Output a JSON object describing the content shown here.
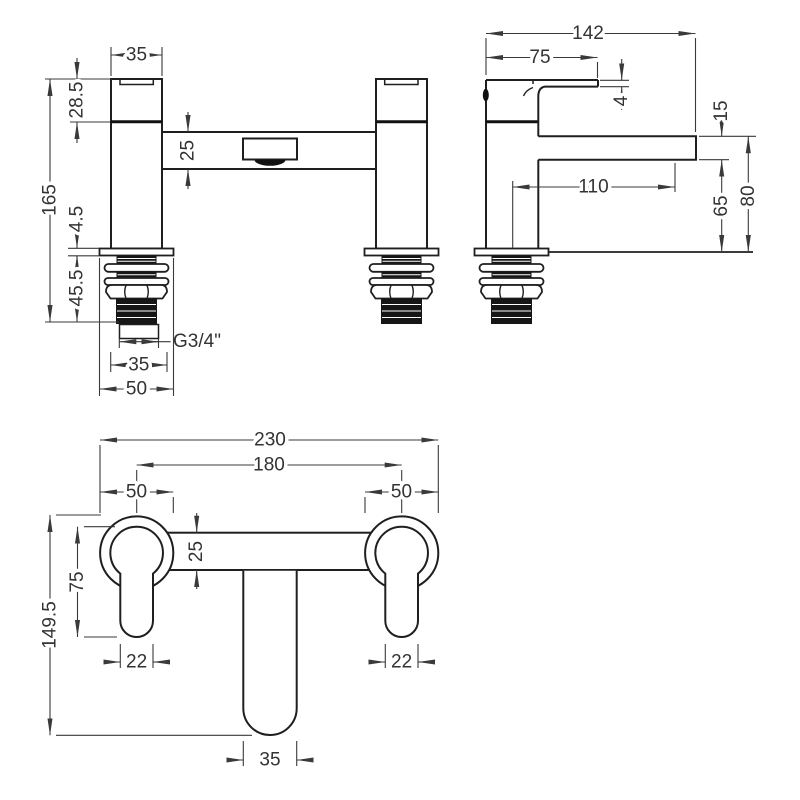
{
  "drawing": {
    "background": "#ffffff",
    "line_color": "#1f1f1f",
    "dimension_color": "#3a3a3a",
    "views": {
      "front": {
        "name": "front elevation",
        "dims": {
          "body_width": "35",
          "handle_height": "28.5",
          "bar_depth": "25",
          "total_height": "165",
          "flange_thickness": "4.5",
          "thread_length": "45.5",
          "thread_size": "G3/4\"",
          "nut_width": "35",
          "base_width": "50"
        }
      },
      "side": {
        "name": "side elevation",
        "dims": {
          "overall_depth": "142",
          "handle_reach": "75",
          "lever_thickness": "4",
          "spout_thickness": "15",
          "spout_reach": "110",
          "spout_clearance": "65",
          "height_above_deck": "80"
        }
      },
      "plan": {
        "name": "plan view",
        "dims": {
          "overall_width": "230",
          "tap_centres": "180",
          "left_flange_dia": "50",
          "right_flange_dia": "50",
          "bar_width": "25",
          "handle_length": "75",
          "overall_depth": "149.5",
          "left_lever_width": "22",
          "right_lever_width": "22",
          "spout_width": "35"
        }
      }
    }
  }
}
